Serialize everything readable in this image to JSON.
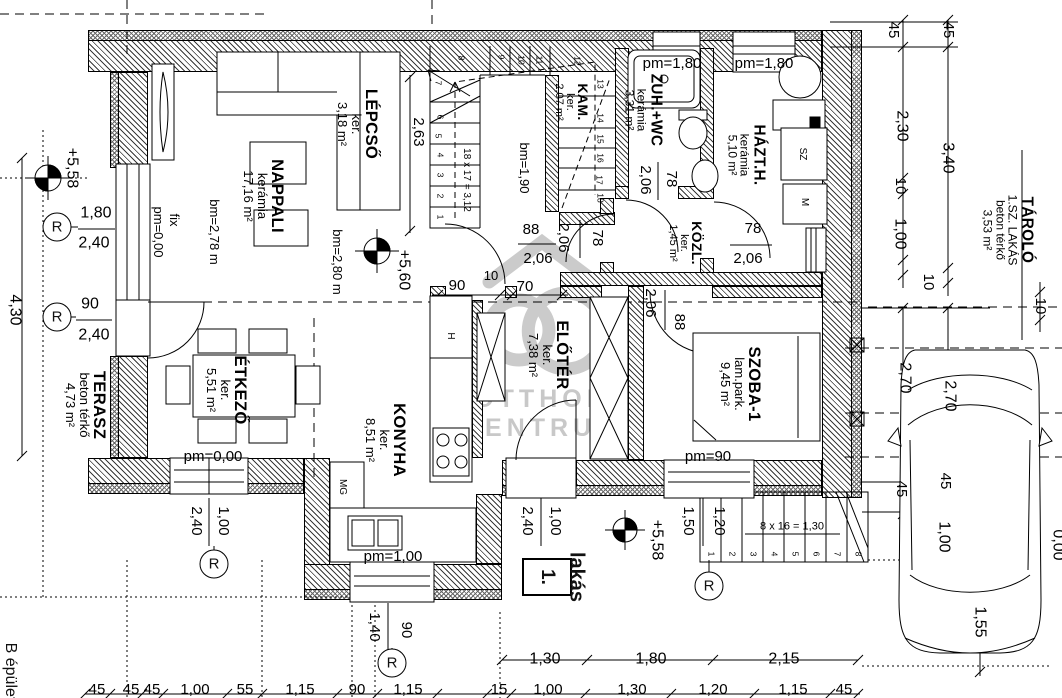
{
  "watermark": {
    "line1": "OTTHON",
    "line2": "CENTRUM"
  },
  "unit": {
    "name": "lakás",
    "number": "1."
  },
  "building": {
    "label": "B épület"
  },
  "rooms": [
    {
      "lines": [
        "NAPPALI",
        "kerámia",
        "17,16 m²"
      ],
      "x": 264,
      "y": 196,
      "s": 13
    },
    {
      "lines": [
        "LÉPCSŐ",
        "ker.",
        "3,18 m²"
      ],
      "x": 358,
      "y": 124,
      "s": 13
    },
    {
      "lines": [
        "KAM.",
        "ker.",
        "2,07 m²"
      ],
      "x": 571,
      "y": 102,
      "s": 11
    },
    {
      "lines": [
        "ZUH.+WC",
        "kerámia",
        "3,31 m²"
      ],
      "x": 643,
      "y": 110,
      "s": 12
    },
    {
      "lines": [
        "HÁZT.H.",
        "kerámia",
        "5,10 m²"
      ],
      "x": 746,
      "y": 155,
      "s": 12
    },
    {
      "lines": [
        "KÖZL.",
        "ker.",
        "1,45 m²"
      ],
      "x": 685,
      "y": 243,
      "s": 11
    },
    {
      "lines": [
        "ELŐTÉR",
        "ker.",
        "7,38 m²"
      ],
      "x": 549,
      "y": 355,
      "s": 13
    },
    {
      "lines": [
        "SZOBA-1",
        "lam.park.",
        "9,45 m²"
      ],
      "x": 741,
      "y": 384,
      "s": 13
    },
    {
      "lines": [
        "KONYHA",
        "ker.",
        "8,51 m²"
      ],
      "x": 386,
      "y": 440,
      "s": 13
    },
    {
      "lines": [
        "ÉTKEZŐ",
        "ker.",
        "5,51 m²"
      ],
      "x": 227,
      "y": 390,
      "s": 13
    },
    {
      "lines": [
        "TERASZ",
        "beton térkő",
        "4,73 m²"
      ],
      "x": 86,
      "y": 405,
      "s": 13
    },
    {
      "lines": [
        "TÁROLÓ",
        "1.SZ. LAKÁS",
        "beton térkő",
        "3,53 m²"
      ],
      "x": 1008,
      "y": 230,
      "s": 12
    }
  ],
  "dims": [
    {
      "t": "+5,58",
      "x": 71,
      "y": 168,
      "r": 90,
      "s": 16
    },
    {
      "t": "1,80",
      "x": 96,
      "y": 214,
      "s": 16
    },
    {
      "t": "2,40",
      "x": 94,
      "y": 244,
      "s": 16
    },
    {
      "t": "90",
      "x": 90,
      "y": 305,
      "s": 16
    },
    {
      "t": "2,40",
      "x": 94,
      "y": 336,
      "s": 16
    },
    {
      "t": "4,30",
      "x": 14,
      "y": 310,
      "r": 90,
      "s": 16
    },
    {
      "t": "fix",
      "x": 174,
      "y": 220,
      "r": 90,
      "s": 13
    },
    {
      "t": "pm=0,00",
      "x": 158,
      "y": 232,
      "r": 90,
      "s": 13
    },
    {
      "t": "bm=2,78 m",
      "x": 214,
      "y": 232,
      "r": 90,
      "s": 13
    },
    {
      "t": "bm=2,80 m",
      "x": 337,
      "y": 262,
      "r": 90,
      "s": 13
    },
    {
      "t": "2,63",
      "x": 418,
      "y": 132,
      "r": 90,
      "s": 15
    },
    {
      "t": "bm=1,90",
      "x": 524,
      "y": 168,
      "r": 90,
      "s": 13
    },
    {
      "t": "+5,60",
      "x": 403,
      "y": 270,
      "r": 90,
      "s": 16
    },
    {
      "t": "88",
      "x": 531,
      "y": 230
    },
    {
      "t": "2,06",
      "x": 538,
      "y": 259
    },
    {
      "t": "78",
      "x": 597,
      "y": 238,
      "r": 90
    },
    {
      "t": "2,06",
      "x": 563,
      "y": 238,
      "r": 90
    },
    {
      "t": "78",
      "x": 671,
      "y": 179,
      "r": 90
    },
    {
      "t": "2,06",
      "x": 645,
      "y": 180,
      "r": 90
    },
    {
      "t": "pm=1,80",
      "x": 672,
      "y": 64
    },
    {
      "t": "pm=1,80",
      "x": 764,
      "y": 64
    },
    {
      "t": "78",
      "x": 753,
      "y": 229
    },
    {
      "t": "2,06",
      "x": 748,
      "y": 259
    },
    {
      "t": "90",
      "x": 457,
      "y": 286
    },
    {
      "t": "10",
      "x": 491,
      "y": 276,
      "s": 13
    },
    {
      "t": "70",
      "x": 525,
      "y": 287
    },
    {
      "t": "2,06",
      "x": 650,
      "y": 303,
      "r": 90
    },
    {
      "t": "88",
      "x": 679,
      "y": 322,
      "r": 90
    },
    {
      "t": "pm=90",
      "x": 708,
      "y": 457
    },
    {
      "t": "pm=0,00",
      "x": 213,
      "y": 457
    },
    {
      "t": "pm=1,00",
      "x": 393,
      "y": 557
    },
    {
      "t": "1,00",
      "x": 223,
      "y": 521,
      "r": 90
    },
    {
      "t": "2,40",
      "x": 196,
      "y": 521,
      "r": 90
    },
    {
      "t": "1,40",
      "x": 374,
      "y": 627,
      "r": 90
    },
    {
      "t": "90",
      "x": 406,
      "y": 630,
      "r": 90
    },
    {
      "t": "1,00",
      "x": 555,
      "y": 521,
      "r": 90
    },
    {
      "t": "2,40",
      "x": 527,
      "y": 521,
      "r": 90
    },
    {
      "t": "1,50",
      "x": 688,
      "y": 521,
      "r": 90
    },
    {
      "t": "1,20",
      "x": 719,
      "y": 521,
      "r": 90
    },
    {
      "t": "+5,58",
      "x": 656,
      "y": 540,
      "r": 90,
      "s": 16
    },
    {
      "t": "1,30",
      "x": 545,
      "y": 660,
      "s": 16
    },
    {
      "t": "1,80",
      "x": 651,
      "y": 660,
      "s": 16
    },
    {
      "t": "2,15",
      "x": 784,
      "y": 660,
      "s": 16
    },
    {
      "t": "45",
      "x": 97,
      "y": 690
    },
    {
      "t": "45",
      "x": 131,
      "y": 690
    },
    {
      "t": "45",
      "x": 152,
      "y": 690
    },
    {
      "t": "1,00",
      "x": 195,
      "y": 690
    },
    {
      "t": "55",
      "x": 245,
      "y": 690
    },
    {
      "t": "1,15",
      "x": 300,
      "y": 690
    },
    {
      "t": "90",
      "x": 357,
      "y": 690
    },
    {
      "t": "1,15",
      "x": 408,
      "y": 690
    },
    {
      "t": "15",
      "x": 499,
      "y": 690
    },
    {
      "t": "1,00",
      "x": 548,
      "y": 690
    },
    {
      "t": "1,30",
      "x": 632,
      "y": 690
    },
    {
      "t": "1,20",
      "x": 713,
      "y": 690
    },
    {
      "t": "1,15",
      "x": 793,
      "y": 690
    },
    {
      "t": "45",
      "x": 844,
      "y": 690
    },
    {
      "t": "45",
      "x": 893,
      "y": 30,
      "r": 90
    },
    {
      "t": "45",
      "x": 948,
      "y": 30,
      "r": 90
    },
    {
      "t": "2,30",
      "x": 901,
      "y": 126,
      "r": 90,
      "s": 16
    },
    {
      "t": "3,40",
      "x": 947,
      "y": 158,
      "r": 90,
      "s": 16
    },
    {
      "t": "10",
      "x": 900,
      "y": 186,
      "r": 90
    },
    {
      "t": "1,00",
      "x": 899,
      "y": 234,
      "r": 90,
      "s": 16
    },
    {
      "t": "10",
      "x": 928,
      "y": 282,
      "r": 90
    },
    {
      "t": "10",
      "x": 1040,
      "y": 306,
      "r": 90
    },
    {
      "t": "2,70",
      "x": 904,
      "y": 378,
      "r": 90,
      "s": 16
    },
    {
      "t": "2,70",
      "x": 949,
      "y": 396,
      "r": 90,
      "s": 16
    },
    {
      "t": "45",
      "x": 901,
      "y": 489,
      "r": 90
    },
    {
      "t": "45",
      "x": 945,
      "y": 481,
      "r": 90
    },
    {
      "t": "1,00",
      "x": 943,
      "y": 537,
      "r": 90,
      "s": 16
    },
    {
      "t": "1,55",
      "x": 979,
      "y": 622,
      "r": 90,
      "s": 16
    },
    {
      "t": "0,00",
      "x": 1057,
      "y": 545,
      "r": 90,
      "s": 16
    }
  ],
  "stairs": {
    "internal": {
      "formula": {
        "t": "18 x 17 = 3,12",
        "x": 466,
        "y": 180,
        "r": 90,
        "s": 10
      },
      "numbers": [
        {
          "t": "1",
          "x": 440,
          "y": 217
        },
        {
          "t": "2",
          "x": 440,
          "y": 196
        },
        {
          "t": "3",
          "x": 440,
          "y": 175
        },
        {
          "t": "4",
          "x": 440,
          "y": 155
        },
        {
          "t": "5",
          "x": 438,
          "y": 136
        },
        {
          "t": "6",
          "x": 440,
          "y": 117
        },
        {
          "t": "7",
          "x": 438,
          "y": 83
        },
        {
          "t": "8",
          "x": 461,
          "y": 58
        },
        {
          "t": "9",
          "x": 501,
          "y": 57
        },
        {
          "t": "10",
          "x": 521,
          "y": 60
        },
        {
          "t": "11",
          "x": 539,
          "y": 60
        },
        {
          "t": "12",
          "x": 577,
          "y": 61
        },
        {
          "t": "13",
          "x": 600,
          "y": 84
        },
        {
          "t": "14",
          "x": 600,
          "y": 118
        },
        {
          "t": "15",
          "x": 600,
          "y": 139
        },
        {
          "t": "16",
          "x": 600,
          "y": 158
        },
        {
          "t": "17",
          "x": 599,
          "y": 180
        },
        {
          "t": "18",
          "x": 600,
          "y": 198
        }
      ]
    },
    "external": {
      "formula": {
        "t": "8 x 16 = 1,30",
        "x": 792,
        "y": 527,
        "s": 11
      },
      "numbers": [
        {
          "t": "1",
          "x": 711,
          "y": 554
        },
        {
          "t": "2",
          "x": 732,
          "y": 554
        },
        {
          "t": "3",
          "x": 753,
          "y": 554
        },
        {
          "t": "4",
          "x": 774,
          "y": 554
        },
        {
          "t": "5",
          "x": 795,
          "y": 554
        },
        {
          "t": "6",
          "x": 816,
          "y": 554
        },
        {
          "t": "7",
          "x": 837,
          "y": 554
        },
        {
          "t": "8",
          "x": 858,
          "y": 554
        }
      ]
    }
  },
  "appliances": [
    {
      "t": "H",
      "x": 450,
      "y": 336
    },
    {
      "t": "MG",
      "x": 342,
      "y": 487
    },
    {
      "t": "SZ",
      "x": 802,
      "y": 154
    },
    {
      "t": "M",
      "x": 804,
      "y": 202
    }
  ],
  "r_markers": {
    "label": "R",
    "points": [
      [
        57,
        227
      ],
      [
        57,
        317
      ],
      [
        214,
        564
      ],
      [
        392,
        663
      ],
      [
        709,
        586
      ]
    ]
  }
}
